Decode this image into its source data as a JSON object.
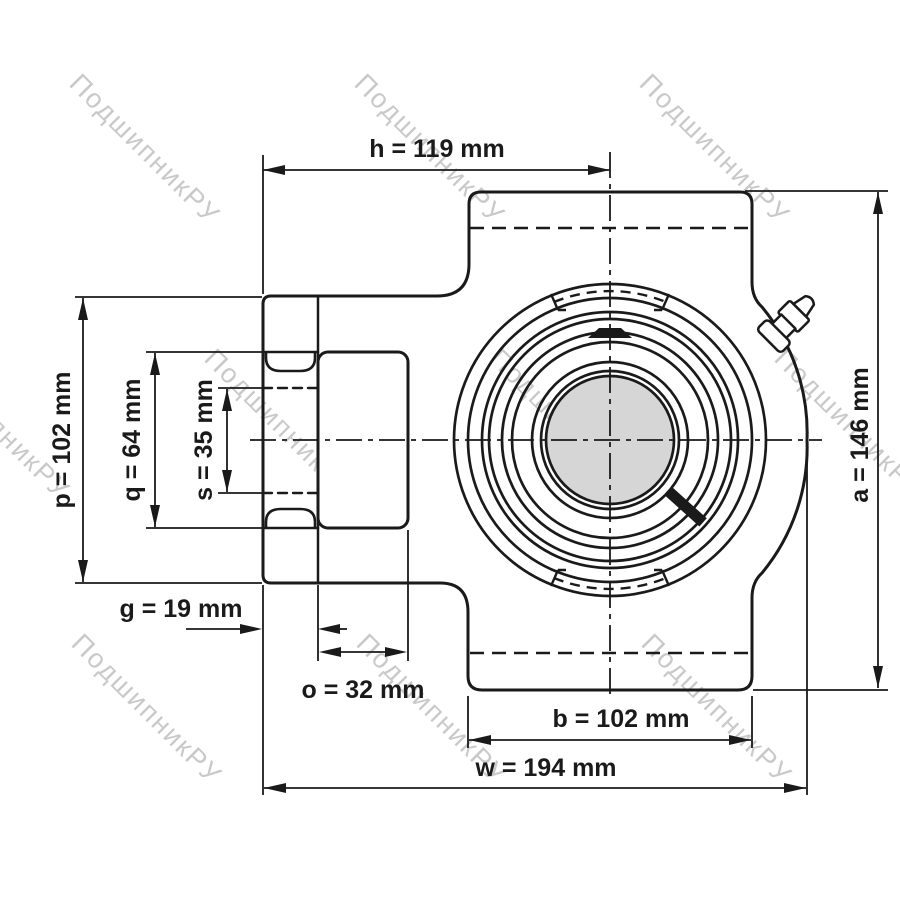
{
  "watermark": {
    "text": "ПодшипникРУ",
    "color": "#c9c9c9"
  },
  "drawing": {
    "description": "Take-up bearing unit outline drawing, front view",
    "colors": {
      "line": "#1a1a1a",
      "bore_fill": "#d6d6d6",
      "background": "#ffffff"
    },
    "labels": {
      "h": "h = 119 mm",
      "p": "p = 102 mm",
      "q": "q = 64 mm",
      "s": "s = 35 mm",
      "g": "g = 19 mm",
      "o": "o = 32 mm",
      "b": "b = 102 mm",
      "w": "w = 194 mm",
      "a": "a = 146 mm"
    },
    "dimensions": [
      {
        "name": "h",
        "value_mm": 119
      },
      {
        "name": "p",
        "value_mm": 102
      },
      {
        "name": "q",
        "value_mm": 64
      },
      {
        "name": "s",
        "value_mm": 35
      },
      {
        "name": "g",
        "value_mm": 19
      },
      {
        "name": "o",
        "value_mm": 32
      },
      {
        "name": "b",
        "value_mm": 102
      },
      {
        "name": "w",
        "value_mm": 194
      },
      {
        "name": "a",
        "value_mm": 146
      }
    ]
  }
}
